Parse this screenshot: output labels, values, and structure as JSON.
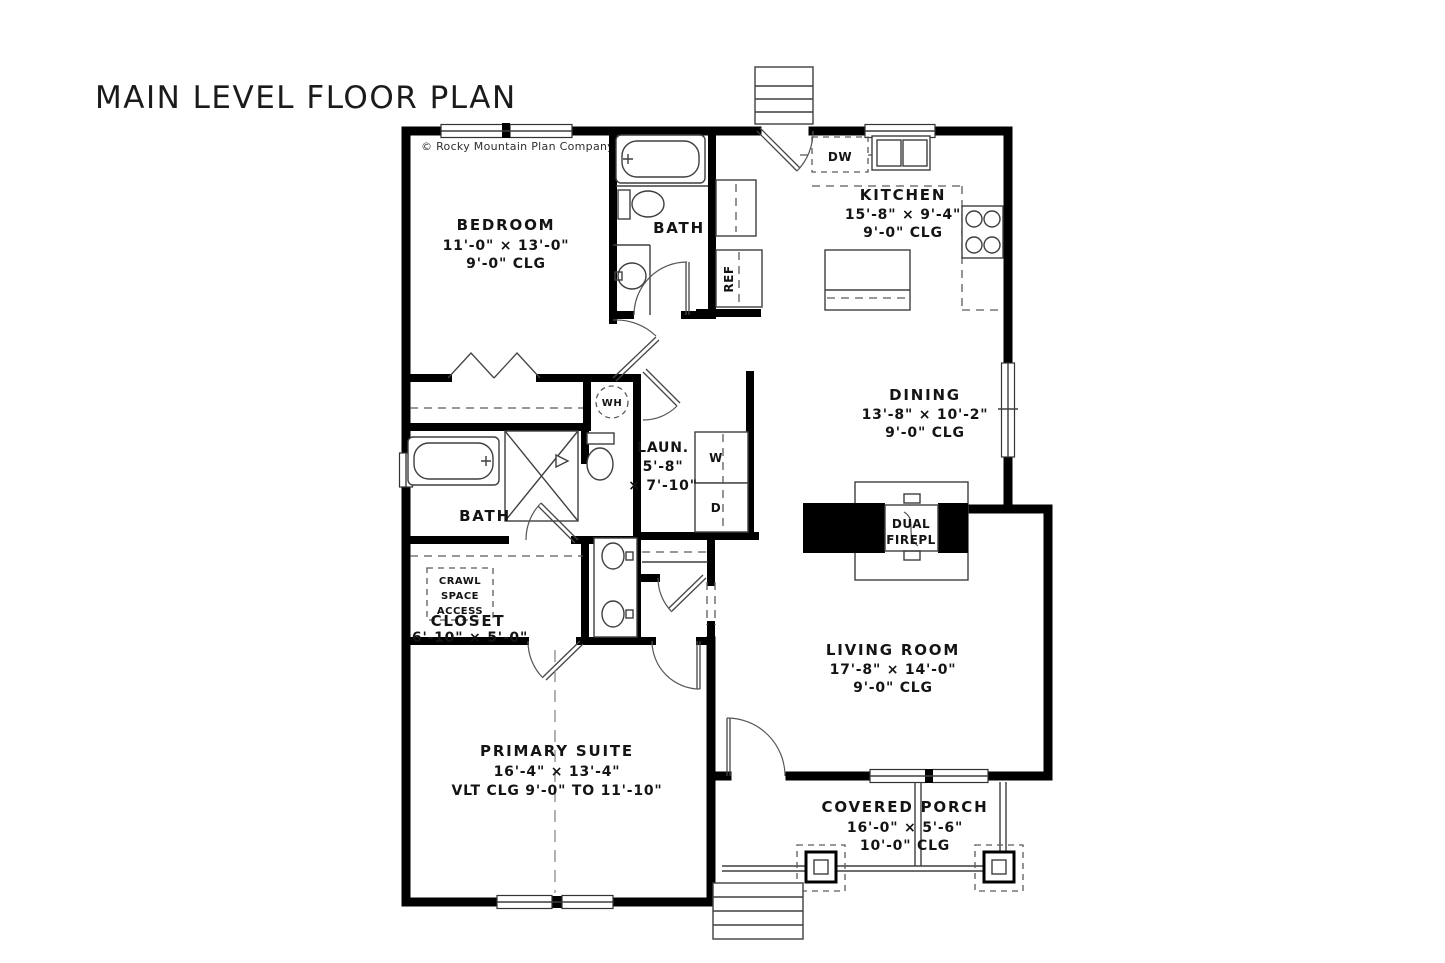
{
  "page": {
    "title": "MAIN LEVEL FLOOR PLAN",
    "copyright": "© Rocky Mountain Plan Company, LLC"
  },
  "rooms": {
    "bedroom": {
      "name": "BEDROOM",
      "dims": "11'-0\" × 13'-0\"",
      "clg": "9'-0\" CLG"
    },
    "bath1": {
      "name": "BATH"
    },
    "kitchen": {
      "name": "KITCHEN",
      "dims": "15'-8\" × 9'-4\"",
      "clg": "9'-0\" CLG"
    },
    "dining": {
      "name": "DINING",
      "dims": "13'-8\" × 10'-2\"",
      "clg": "9'-0\" CLG"
    },
    "laundry": {
      "name": "LAUN.",
      "dims1": "5'-8\"",
      "dims2": "× 7'-10\""
    },
    "bath2": {
      "name": "BATH"
    },
    "closet": {
      "name": "CLOSET",
      "dims": "6'-10\" × 5'-0\""
    },
    "living": {
      "name": "LIVING ROOM",
      "dims": "17'-8\" × 14'-0\"",
      "clg": "9'-0\" CLG"
    },
    "primary": {
      "name": "PRIMARY SUITE",
      "dims": "16'-4\" × 13'-4\"",
      "clg": "VLT CLG 9'-0\" TO 11'-10\""
    },
    "porch": {
      "name": "COVERED PORCH",
      "dims": "16'-0\" × 5'-6\"",
      "clg": "10'-0\" CLG"
    }
  },
  "labels": {
    "dishwasher": "DW",
    "refrigerator": "REF",
    "washer": "W",
    "dryer": "D",
    "water_heater": "WH",
    "fireplace1": "DUAL",
    "fireplace2": "FIREPL",
    "crawl1": "CRAWL",
    "crawl2": "SPACE",
    "crawl3": "ACCESS"
  },
  "colors": {
    "wall": "#000000",
    "line": "#3f3f3f",
    "text": "#141414",
    "background": "#ffffff"
  }
}
